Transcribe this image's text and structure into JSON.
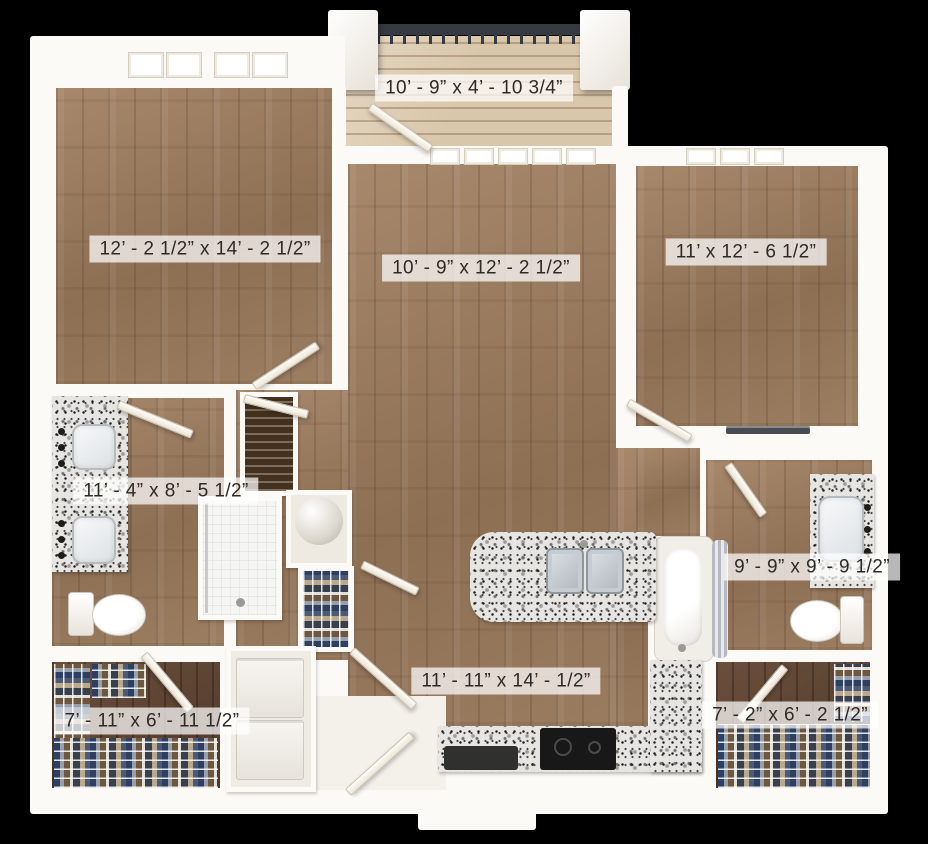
{
  "plan": {
    "rooms": [
      {
        "id": "balcony",
        "label": "10’ - 9” x 4’ - 10 3/4”"
      },
      {
        "id": "bedroom-1",
        "label": "12’ - 2 1/2” x 14’ - 2 1/2”"
      },
      {
        "id": "living-room",
        "label": "10’ - 9” x 12’ - 2 1/2”"
      },
      {
        "id": "bedroom-2",
        "label": "11’ x 12’ - 6 1/2”"
      },
      {
        "id": "bathroom-1",
        "label": "11’ - 4” x 8’ - 5 1/2”"
      },
      {
        "id": "bathroom-2",
        "label": "9’ - 9” x 9’ - 9 1/2”"
      },
      {
        "id": "kitchen",
        "label": "11’ - 11” x 14’ - 1/2”"
      },
      {
        "id": "closet-1",
        "label": "7’ - 11” x 6’ - 11 1/2”"
      },
      {
        "id": "closet-2",
        "label": "7’ - 2” x 6’ - 2 1/2”"
      }
    ],
    "colors": {
      "background": "#000000",
      "wall": "#fbfaf6",
      "wood_floor": "#97795d",
      "dark_wood": "#5a4232",
      "deck": "#d9c7ab",
      "granite": "#e7e5e1",
      "railing": "#363b41"
    }
  }
}
